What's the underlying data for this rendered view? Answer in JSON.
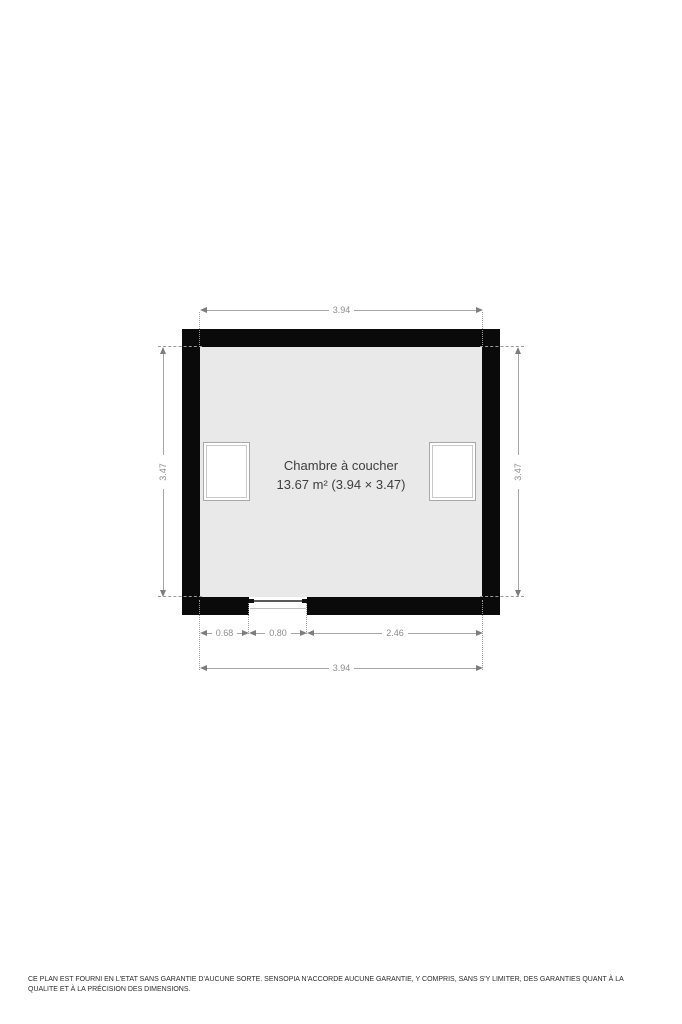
{
  "floorplan": {
    "room": {
      "name": "Chambre à coucher",
      "area_line": "13.67 m² (3.94 × 3.47)"
    },
    "dimensions": {
      "top_width": "3.94",
      "left_height": "3.47",
      "right_height": "3.47",
      "bottom_seg1": "0.68",
      "bottom_seg2": "0.80",
      "bottom_seg3": "2.46",
      "bottom_total": "3.94"
    },
    "colors": {
      "wall": "#0a0a0a",
      "floor": "#e9e9e9",
      "dimension_line": "#a6a6a6",
      "dimension_text": "#8d8d8d",
      "label_text": "#3e3e3e"
    }
  },
  "footer": {
    "disclaimer": "CE PLAN EST FOURNI EN L'ETAT SANS GARANTIE D'AUCUNE SORTE. SENSOPIA N'ACCORDE AUCUNE GARANTIE, Y COMPRIS, SANS S'Y LIMITER, DES GARANTIES QUANT À LA QUALITE ET À LA PRÉCISION DES DIMENSIONS."
  }
}
